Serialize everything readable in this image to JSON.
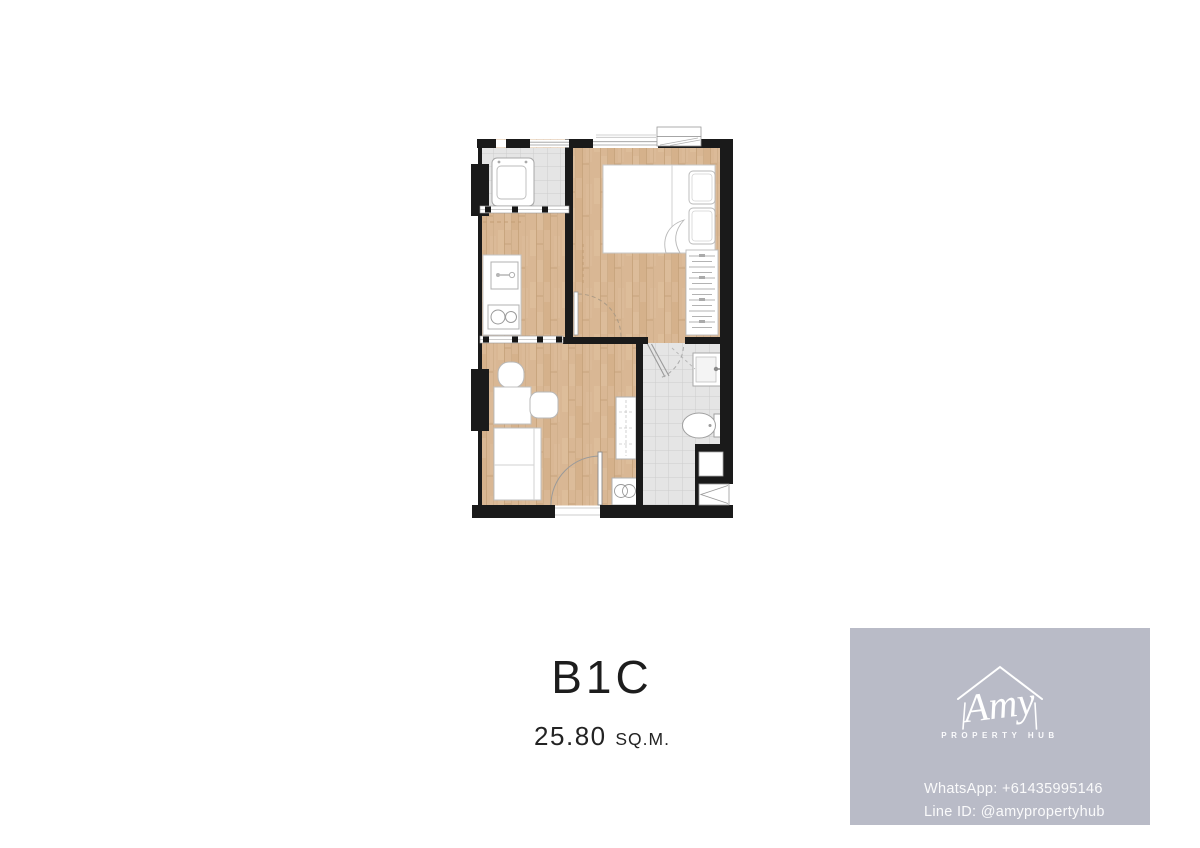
{
  "page": {
    "background": "#ffffff"
  },
  "unit": {
    "name": "B1C",
    "area": "25.80",
    "area_unit": "SQ.M."
  },
  "branding": {
    "box_color": "#b9bbc7",
    "logo_script": "Amy",
    "logo_subtitle": "PROPERTY HUB",
    "contacts": {
      "whatsapp": "WhatsApp: +61435995146",
      "line": "Line ID: @amypropertyhub"
    }
  },
  "floorplan": {
    "colors": {
      "wall": "#1a1a1a",
      "wood_floor": "#d9b794",
      "tile_floor": "#e5e5e5",
      "furniture_outline": "#bdbdbd"
    },
    "rooms": [
      "balcony",
      "kitchen",
      "bedroom",
      "bathroom",
      "living-area",
      "entry-corridor"
    ],
    "furniture_icons": [
      "washing-machine-icon",
      "kitchen-sink-icon",
      "stove-icon",
      "bed-icon",
      "pillow-icon",
      "blanket-fold-icon",
      "wardrobe-icon",
      "air-conditioner-icon",
      "desk-icon",
      "chair-icon",
      "sofa-icon",
      "cabinet-icon",
      "appliance-icon",
      "bathroom-sink-icon",
      "toilet-icon",
      "door-swing-icon",
      "shaft-icon",
      "window-icon"
    ]
  }
}
